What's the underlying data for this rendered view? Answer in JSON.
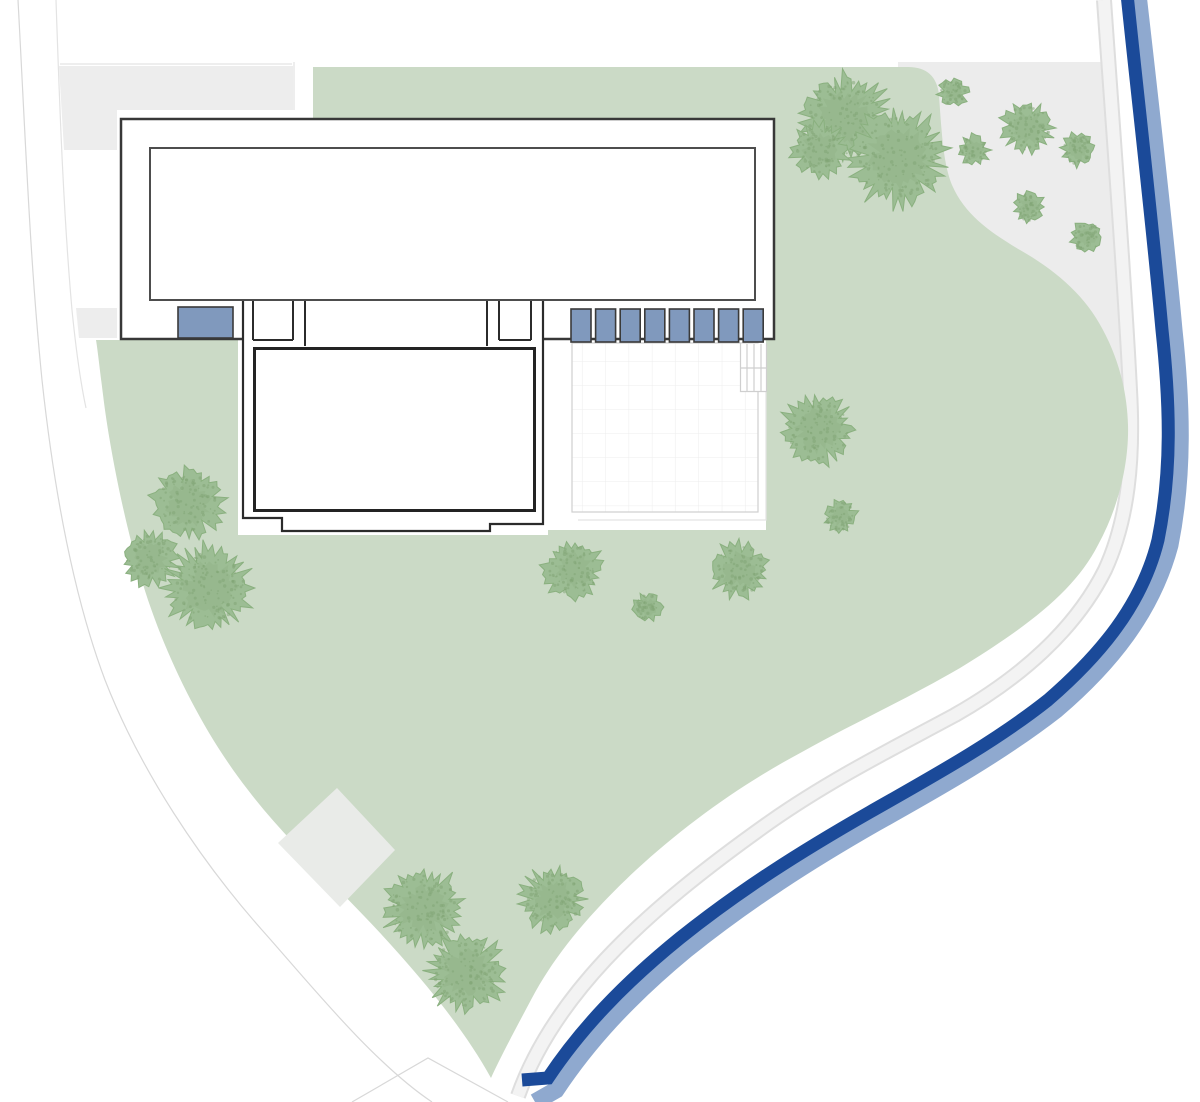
{
  "plan": {
    "kind": "architectural-site-plan",
    "features": {
      "building": "main-house-with-south-wing",
      "water": "river-along-east-and-south-edge",
      "ground": "lawn-with-scattered-trees",
      "hardscape": [
        "gravel-area-north-east",
        "terrace-with-grid",
        "paved-diamond",
        "perimeter-road-west"
      ]
    }
  },
  "colors": {
    "background": "#ffffff",
    "lawn": "#cbdac6",
    "tree": "#9cbd94",
    "tree_dark": "#7fa473",
    "tree_edge": "#8ab07f",
    "neighbor": "#ededed",
    "gravel": "#ececec",
    "path_fill": "#f3f3f3",
    "path_edge": "#dedede",
    "river": "#1b4a99",
    "river_light": "#8fa9cf",
    "wall": "#383838",
    "wall_inner": "#4d4d4d",
    "wing_wall": "#2b2b2b",
    "room_wall": "#232323",
    "window_fill": "#8099bd",
    "window_border": "#3a3a3a",
    "terrace_line": "#cfcfcf",
    "grid_line": "#ededed",
    "road_line": "#d8d8d8",
    "faint_line": "#e3e3e3",
    "diamond": "#e9ebe8",
    "white": "#ffffff"
  },
  "building": {
    "windows": {
      "left": {
        "x": 178,
        "y": 307,
        "w": 55,
        "h": 31
      },
      "row": {
        "count": 8,
        "x": 571,
        "y": 309,
        "w": 20,
        "pitch": 24.6,
        "h": 33
      }
    }
  },
  "trees": [
    {
      "cx": 845,
      "cy": 118,
      "r": 48
    },
    {
      "cx": 898,
      "cy": 158,
      "r": 52
    },
    {
      "cx": 820,
      "cy": 150,
      "r": 30
    },
    {
      "cx": 953,
      "cy": 92,
      "r": 16
    },
    {
      "cx": 1027,
      "cy": 128,
      "r": 28
    },
    {
      "cx": 974,
      "cy": 150,
      "r": 17
    },
    {
      "cx": 1078,
      "cy": 150,
      "r": 18
    },
    {
      "cx": 1029,
      "cy": 207,
      "r": 17
    },
    {
      "cx": 1087,
      "cy": 237,
      "r": 17
    },
    {
      "cx": 818,
      "cy": 430,
      "r": 38
    },
    {
      "cx": 840,
      "cy": 516,
      "r": 18
    },
    {
      "cx": 188,
      "cy": 503,
      "r": 38
    },
    {
      "cx": 150,
      "cy": 558,
      "r": 30
    },
    {
      "cx": 208,
      "cy": 588,
      "r": 46
    },
    {
      "cx": 573,
      "cy": 570,
      "r": 32
    },
    {
      "cx": 648,
      "cy": 607,
      "r": 16
    },
    {
      "cx": 739,
      "cy": 570,
      "r": 31
    },
    {
      "cx": 424,
      "cy": 908,
      "r": 43
    },
    {
      "cx": 553,
      "cy": 899,
      "r": 35
    },
    {
      "cx": 466,
      "cy": 973,
      "r": 42
    }
  ]
}
